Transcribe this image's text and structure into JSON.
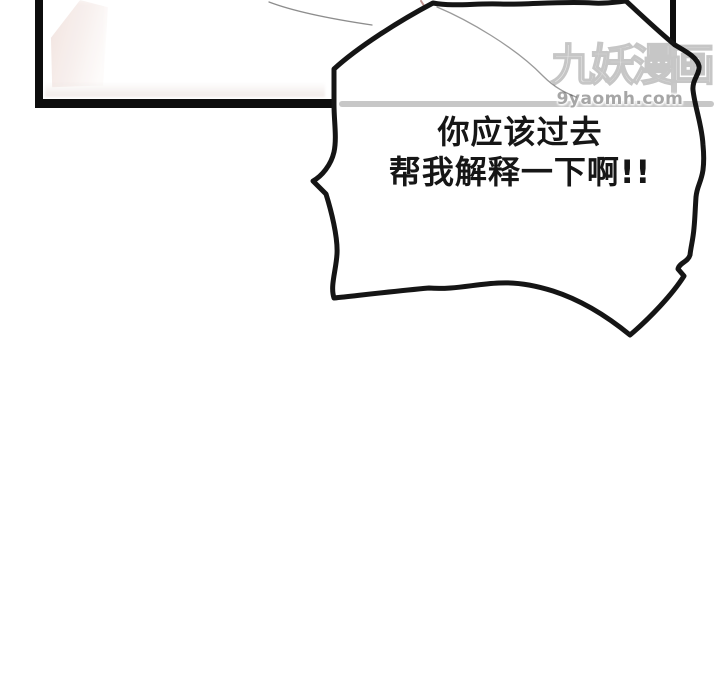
{
  "page": {
    "type": "comic-page",
    "background_color": "#ffffff"
  },
  "speech_bubble": {
    "line1": "你应该过去",
    "line2": "帮我解释一下啊!!",
    "text_color": "#161616",
    "outline_color": "#151515",
    "fill_color": "#ffffff"
  },
  "watermark": {
    "title": "九妖漫画",
    "domain": "9yaomh.com",
    "title_color": "#eaeaea",
    "line_color": "#c7c7c7",
    "domain_color": "#a6a6a6"
  },
  "panel": {
    "border_color": "#0d0d0d",
    "highlight_color": "#f1e3df"
  }
}
